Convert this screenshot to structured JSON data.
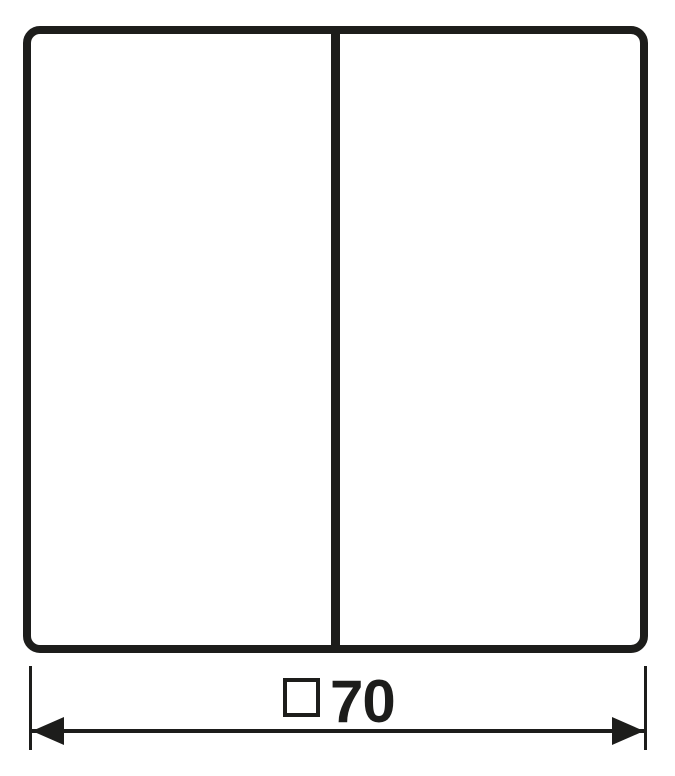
{
  "colors": {
    "background": "#ffffff",
    "line": "#1d1d1b"
  },
  "drawing": {
    "type": "technical-dimension-drawing",
    "outline": {
      "shape": "rounded-square",
      "segments": 2
    },
    "dimension_label": {
      "symbol": "□",
      "value": "70",
      "text": "□70"
    }
  }
}
